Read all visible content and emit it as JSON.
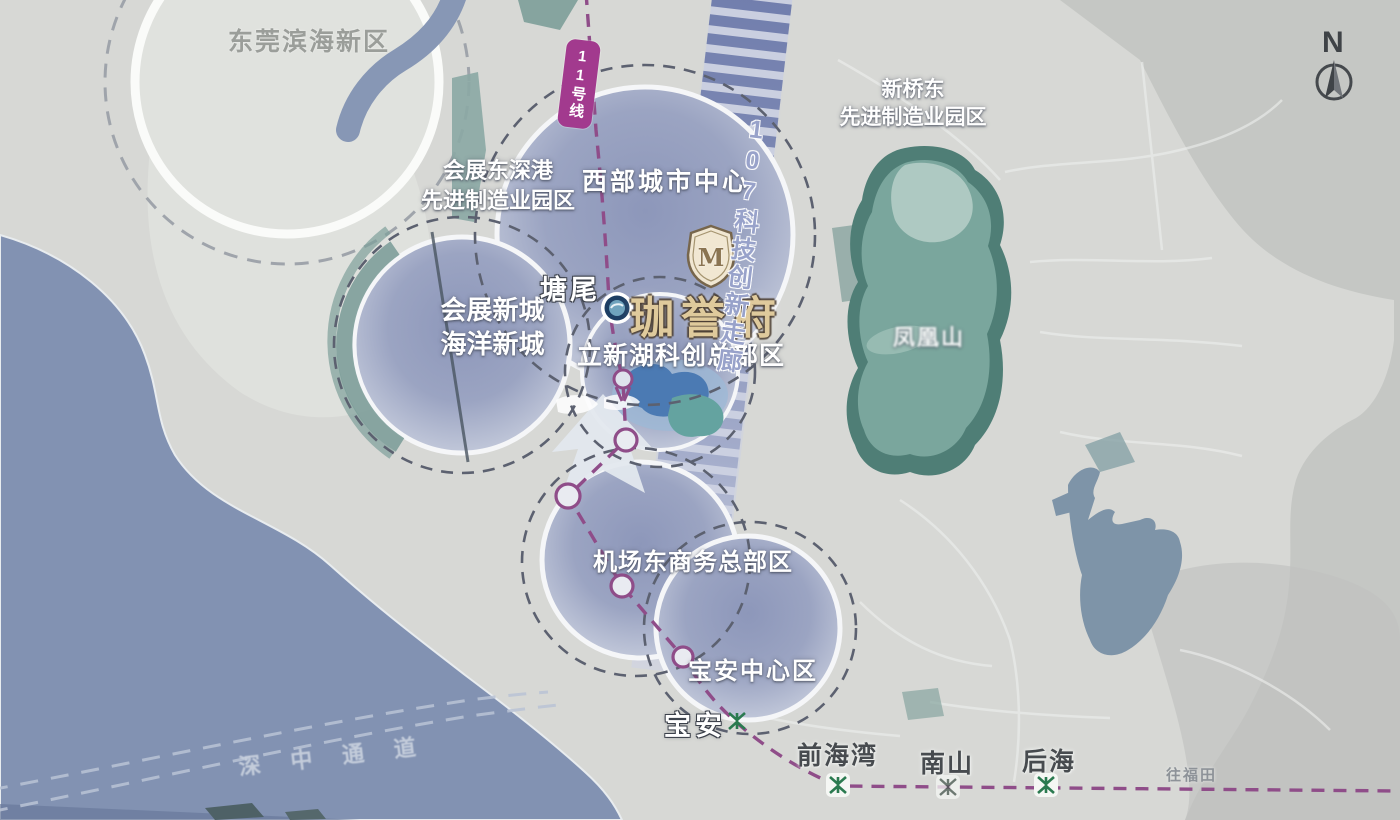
{
  "compass": {
    "label": "N"
  },
  "project": {
    "name": "珈誉府",
    "logo_letter": "M"
  },
  "areas": {
    "dongguan_binhai": "东莞滨海新区",
    "huizhandong_l1": "会展东深港",
    "huizhandong_l2": "先进制造业园区",
    "xibu_center": "西部城市中心",
    "xinqiaodong_l1": "新桥东",
    "xinqiaodong_l2": "先进制造业园区",
    "huizhan_xincheng": "会展新城",
    "haiyang_xincheng": "海洋新城",
    "lixinhu": "立新湖科创总部区",
    "jichangdong": "机场东商务总部区",
    "baoan_center": "宝安中心区",
    "fenghuangshan": "凤凰山"
  },
  "transit": {
    "line11_badge": "11号线",
    "corridor_107": "107科技创新走廊",
    "to_futian": "往福田",
    "shenzhong_bridge": "深中通道",
    "stations": {
      "tangwei": "塘尾",
      "baoan": "宝安",
      "qianhaiwan": "前海湾",
      "nanshan": "南山",
      "houhai": "后海"
    }
  },
  "colors": {
    "sea": "#8292b2",
    "land": "#d7d8d5",
    "land_dark": "#c5c7c4",
    "bubble_fill": "#9aa3c1",
    "corridor_stripe": "#5e6ca2",
    "metro_line": "#8f4d89",
    "line11_badge_bg": "#a23a8e",
    "mountain_green": "#4f7e76",
    "metro_icon_green": "#2b7a50",
    "project_gold": "#dfca9c"
  }
}
